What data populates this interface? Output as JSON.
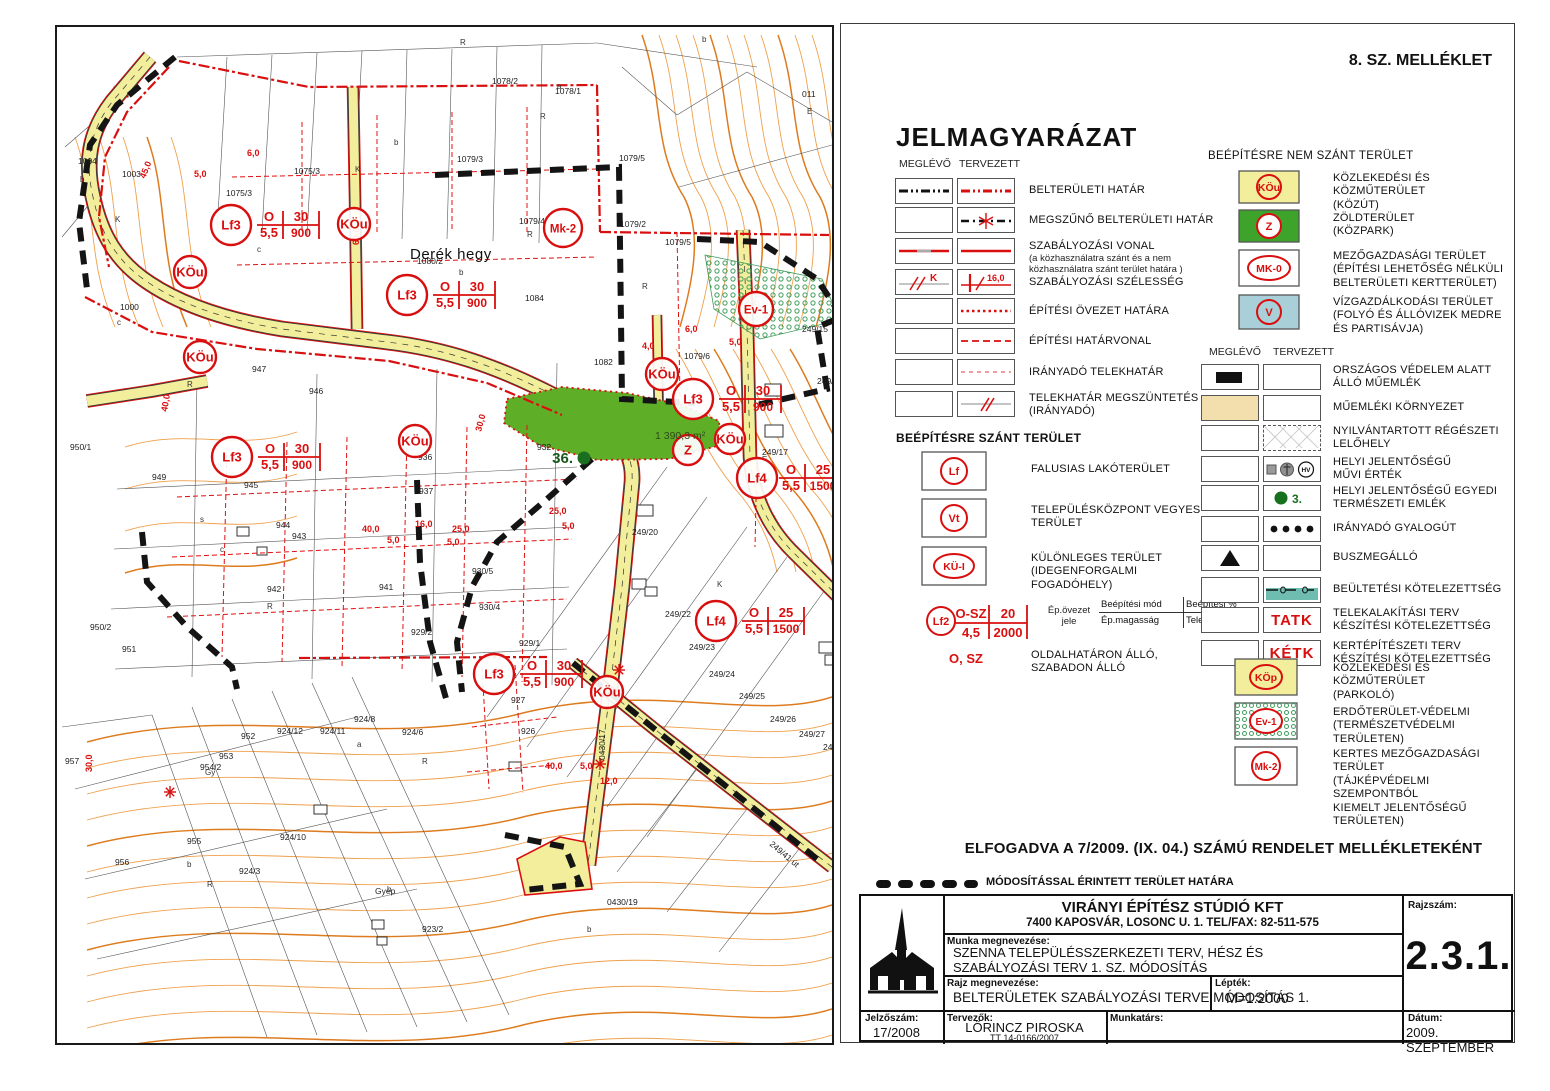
{
  "sheet": {
    "attachment": "8. SZ. MELLÉKLET"
  },
  "legend": {
    "title": "JELMAGYARÁZAT",
    "col_existing": "MEGLÉVŐ",
    "col_planned": "TERVEZETT",
    "left_rows": [
      {
        "label": "BELTERÜLETI HATÁR"
      },
      {
        "label": "MEGSZŰNŐ BELTERÜLETI HATÁR"
      },
      {
        "label": "SZABÁLYOZÁSI VONAL",
        "note": "(a közhasználatra szánt és a nem\nközhasználatra szánt terület határa )"
      },
      {
        "label": "SZABÁLYOZÁSI SZÉLESSÉG",
        "k": "K",
        "w": "16,0"
      },
      {
        "label": "ÉPÍTÉSI ÖVEZET HATÁRA"
      },
      {
        "label": "ÉPÍTÉSI HATÁRVONAL"
      },
      {
        "label": "IRÁNYADÓ TELEKHATÁR"
      },
      {
        "label": "TELEKHATÁR MEGSZÜNTETÉS\n(IRÁNYADÓ)"
      }
    ],
    "szant": {
      "header": "BEÉPÍTÉSRE SZÁNT TERÜLET",
      "items": [
        {
          "symbol": "Lf",
          "label": "FALUSIAS LAKÓTERÜLET"
        },
        {
          "symbol": "Vt",
          "label": "TELEPÜLÉSKÖZPONT VEGYES\nTERÜLET"
        },
        {
          "symbol": "KÜ-I",
          "label": "KÜLÖNLEGES TERÜLET\n(IDEGENFORGALMI FOGADÓHELY)"
        }
      ],
      "formula": {
        "symbol": "Lf2",
        "tl": "O-SZ",
        "tr": "20",
        "bl": "4,5",
        "br": "2000",
        "caption_left": "Ép.övezet\njele",
        "cap_tl": "Beépítési mód",
        "cap_tr": "Beépítési %",
        "cap_bl": "Ép.magasság",
        "cap_br": "Telekterület"
      },
      "osz": {
        "symbol": "O, SZ",
        "label": "OLDALHATÁRON ÁLLÓ,\nSZABADON ÁLLÓ"
      }
    },
    "nem_szant": {
      "header": "BEÉPÍTÉSRE NEM  SZÁNT TERÜLET",
      "items": [
        {
          "symbol": "KÖu",
          "fill": "#f2ee9b",
          "label": "KÖZLEKEDÉSI ÉS KÖZMŰTERÜLET\n(KÖZÚT)"
        },
        {
          "symbol": "Z",
          "fill": "#3ea32b",
          "label": "ZÖLDTERÜLET\n(KÖZPARK)"
        },
        {
          "symbol": "MK-0",
          "fill": "#ffffff",
          "label": "MEZŐGAZDASÁGI TERÜLET\n(ÉPÍTÉSI LEHETŐSÉG NÉLKÜLI\nBELTERÜLETI KERTTERÜLET)"
        },
        {
          "symbol": "V",
          "fill": "#a9d0d9",
          "label": "VÍZGAZDÁLKODÁSI TERÜLET\n(FOLYÓ ÉS ÁLLÓVIZEK MEDRE\nÉS PARTISÁVJA)"
        }
      ]
    },
    "pair_rows": [
      {
        "label": "ORSZÁGOS VÉDELEM ALATT\nÁLLÓ MŰEMLÉK"
      },
      {
        "label": "MŰEMLÉKI KÖRNYEZET"
      },
      {
        "label": "NYILVÁNTARTOTT RÉGÉSZETI\nLELŐHELY"
      },
      {
        "label": "HELYI JELENTŐSÉGŰ\nMŰVI ÉRTÉK",
        "hv": "HV"
      },
      {
        "label": "HELYI JELENTŐSÉGŰ EGYEDI\nTERMÉSZETI EMLÉK",
        "num": "3."
      },
      {
        "label": "IRÁNYADÓ GYALOGÚT"
      },
      {
        "label": "BUSZMEGÁLLÓ"
      },
      {
        "label": "BEÜLTETÉSI KÖTELEZETTSÉG"
      },
      {
        "label": "TELEKALAKÍTÁSI TERV\nKÉSZÍTÉSI KÖTELEZETTSÉG",
        "mark": "TATK"
      },
      {
        "label": "KERTÉPÍTÉSZETI TERV\nKÉSZÍTÉSI KÖTELEZETTSÉG",
        "mark": "KÉTK"
      }
    ],
    "bottom_symbols": [
      {
        "symbol": "KÖp",
        "label": "KÖZLEKEDÉSI ÉS KÖZMŰTERÜLET\n(PARKOLÓ)"
      },
      {
        "symbol": "Ev-1",
        "label": "ERDŐTERÜLET-VÉDELMI\n(TERMÉSZETVÉDELMI TERÜLETEN)"
      },
      {
        "symbol": "Mk-2",
        "label": "KERTES MEZŐGAZDASÁGI TERÜLET\n(TÁJKÉPVÉDELMI SZEMPONTBÓL\nKIEMELT JELENTŐSÉGŰ TERÜLETEN)"
      }
    ],
    "colors": {
      "red": "#d90f0f",
      "road_yellow": "#f2ee9b",
      "park_green": "#5fae27",
      "water_blue": "#a9d0d9",
      "tan": "#f3dfae",
      "teal": "#6fbcb1"
    }
  },
  "adoption": "ELFOGADVA A 7/2009. (IX. 04.) SZÁMÚ RENDELET MELLÉKLETEKÉNT",
  "modified_boundary": "MÓDOSÍTÁSSAL ÉRINTETT TERÜLET HATÁRA",
  "title_block": {
    "firm": "VIRÁNYI ÉPÍTÉSZ STÚDIÓ KFT",
    "firm_address": "7400 KAPOSVÁR, LOSONC U. 1. TEL/FAX: 82-511-575",
    "work_label": "Munka megnevezése:",
    "work_name": "SZENNA TELEPÜLÉSSZERKEZETI TERV, HÉSZ ÉS\nSZABÁLYOZÁSI TERV 1. SZ. MÓDOSÍTÁS",
    "drawing_label": "Rajz megnevezése:",
    "drawing_name": "BELTERÜLETEK SZABÁLYOZÁSI TERVE MÓDOSÍTÁS 1.",
    "scale_label": "Lépték:",
    "scale": "M=1:2000",
    "number_label": "Rajzszám:",
    "number": "2.3.1.",
    "code_label": "Jelzőszám:",
    "code": "17/2008",
    "designers_label": "Tervezők:",
    "designer": "LŐRINCZ PIROSKA",
    "designer_reg": "TT 14-0166/2007",
    "collaborator_label": "Munkatárs:",
    "date_label": "Dátum:",
    "date": "2009. SZEPTEMBER"
  },
  "map": {
    "place": "Derék hegy",
    "green_area": "1 390,3 m²",
    "monument": "36.",
    "symbols": [
      {
        "t": "KÖu",
        "x": 133,
        "y": 245,
        "r": 16
      },
      {
        "t": "KÖu",
        "x": 143,
        "y": 330,
        "r": 16
      },
      {
        "t": "KÖu",
        "x": 297,
        "y": 197,
        "r": 16
      },
      {
        "t": "KÖu",
        "x": 358,
        "y": 414,
        "r": 16
      },
      {
        "t": "KÖu",
        "x": 605,
        "y": 347,
        "r": 16
      },
      {
        "t": "KÖu",
        "x": 673,
        "y": 412,
        "r": 15
      },
      {
        "t": "KÖu",
        "x": 550,
        "y": 665,
        "r": 16
      },
      {
        "t": "Lf3",
        "x": 174,
        "y": 198,
        "r": 20
      },
      {
        "t": "Lf3",
        "x": 350,
        "y": 268,
        "r": 20
      },
      {
        "t": "Lf3",
        "x": 175,
        "y": 430,
        "r": 20
      },
      {
        "t": "Lf3",
        "x": 636,
        "y": 372,
        "r": 20
      },
      {
        "t": "Lf3",
        "x": 437,
        "y": 647,
        "r": 20
      },
      {
        "t": "Lf4",
        "x": 700,
        "y": 451,
        "r": 20
      },
      {
        "t": "Lf4",
        "x": 659,
        "y": 594,
        "r": 20
      },
      {
        "t": "Mk-2",
        "x": 506,
        "y": 201,
        "r": 19
      },
      {
        "t": "Ev-1",
        "x": 699,
        "y": 282,
        "r": 17
      },
      {
        "t": "Z",
        "x": 631,
        "y": 423,
        "r": 15
      }
    ],
    "tables": [
      {
        "x": 200,
        "y": 198,
        "tl": "O",
        "tr": "30",
        "bl": "5,5",
        "br": "900"
      },
      {
        "x": 376,
        "y": 268,
        "tl": "O",
        "tr": "30",
        "bl": "5,5",
        "br": "900"
      },
      {
        "x": 201,
        "y": 430,
        "tl": "O",
        "tr": "30",
        "bl": "5,5",
        "br": "900"
      },
      {
        "x": 662,
        "y": 372,
        "tl": "O",
        "tr": "30",
        "bl": "5,5",
        "br": "900"
      },
      {
        "x": 463,
        "y": 647,
        "tl": "O",
        "tr": "30",
        "bl": "5,5",
        "br": "900"
      },
      {
        "x": 722,
        "y": 451,
        "tl": "O",
        "tr": "25",
        "bl": "5,5",
        "br": "1500"
      },
      {
        "x": 685,
        "y": 594,
        "tl": "O",
        "tr": "25",
        "bl": "5,5",
        "br": "1500"
      }
    ],
    "parcels": [
      {
        "t": "1004",
        "x": 21,
        "y": 137
      },
      {
        "t": "1003",
        "x": 65,
        "y": 150
      },
      {
        "t": "1000",
        "x": 63,
        "y": 283
      },
      {
        "t": "950/1",
        "x": 13,
        "y": 423
      },
      {
        "t": "949",
        "x": 95,
        "y": 453
      },
      {
        "t": "950/2",
        "x": 33,
        "y": 603
      },
      {
        "t": "951",
        "x": 65,
        "y": 625
      },
      {
        "t": "957",
        "x": 8,
        "y": 737
      },
      {
        "t": "954/2",
        "x": 143,
        "y": 743
      },
      {
        "t": "953",
        "x": 162,
        "y": 732
      },
      {
        "t": "952",
        "x": 184,
        "y": 712
      },
      {
        "t": "955",
        "x": 130,
        "y": 817
      },
      {
        "t": "956",
        "x": 58,
        "y": 838
      },
      {
        "t": "924/12",
        "x": 220,
        "y": 707
      },
      {
        "t": "924/11",
        "x": 263,
        "y": 707
      },
      {
        "t": "924/8",
        "x": 297,
        "y": 695
      },
      {
        "t": "924/6",
        "x": 345,
        "y": 708
      },
      {
        "t": "924/10",
        "x": 223,
        "y": 813
      },
      {
        "t": "924/3",
        "x": 182,
        "y": 847
      },
      {
        "t": "923/2",
        "x": 365,
        "y": 905
      },
      {
        "t": "Gyep",
        "x": 318,
        "y": 867
      },
      {
        "t": "1075/3",
        "x": 237,
        "y": 147
      },
      {
        "t": "1075/3",
        "x": 169,
        "y": 169
      },
      {
        "t": "1078/2",
        "x": 435,
        "y": 57
      },
      {
        "t": "1078/1",
        "x": 498,
        "y": 67
      },
      {
        "t": "1079/3",
        "x": 400,
        "y": 135
      },
      {
        "t": "1079/5",
        "x": 562,
        "y": 134
      },
      {
        "t": "1079/5",
        "x": 608,
        "y": 218
      },
      {
        "t": "1079/4",
        "x": 462,
        "y": 197
      },
      {
        "t": "1079/2",
        "x": 563,
        "y": 200
      },
      {
        "t": "1079/6",
        "x": 627,
        "y": 332
      },
      {
        "t": "1080/2",
        "x": 360,
        "y": 237
      },
      {
        "t": "1082",
        "x": 537,
        "y": 338
      },
      {
        "t": "1084",
        "x": 468,
        "y": 274
      },
      {
        "t": "011",
        "x": 745,
        "y": 70
      },
      {
        "t": "249/15",
        "x": 745,
        "y": 305
      },
      {
        "t": "249/16",
        "x": 760,
        "y": 357
      },
      {
        "t": "249/14",
        "x": 778,
        "y": 409
      },
      {
        "t": "249/17",
        "x": 705,
        "y": 428
      },
      {
        "t": "249/20",
        "x": 575,
        "y": 508
      },
      {
        "t": "249/22",
        "x": 608,
        "y": 590
      },
      {
        "t": "249/23",
        "x": 632,
        "y": 623
      },
      {
        "t": "249/24",
        "x": 652,
        "y": 650
      },
      {
        "t": "249/25",
        "x": 682,
        "y": 672
      },
      {
        "t": "249/26",
        "x": 713,
        "y": 695
      },
      {
        "t": "249/27",
        "x": 742,
        "y": 710
      },
      {
        "t": "249/28",
        "x": 766,
        "y": 723
      },
      {
        "t": "932",
        "x": 480,
        "y": 423
      },
      {
        "t": "936",
        "x": 361,
        "y": 433
      },
      {
        "t": "937",
        "x": 362,
        "y": 467
      },
      {
        "t": "941",
        "x": 322,
        "y": 563
      },
      {
        "t": "942",
        "x": 210,
        "y": 565
      },
      {
        "t": "943",
        "x": 235,
        "y": 512
      },
      {
        "t": "944",
        "x": 219,
        "y": 501
      },
      {
        "t": "945",
        "x": 187,
        "y": 461
      },
      {
        "t": "946",
        "x": 252,
        "y": 367
      },
      {
        "t": "947",
        "x": 195,
        "y": 345
      },
      {
        "t": "929/1",
        "x": 462,
        "y": 619
      },
      {
        "t": "927",
        "x": 454,
        "y": 676
      },
      {
        "t": "926",
        "x": 464,
        "y": 707
      },
      {
        "t": "929/2",
        "x": 354,
        "y": 608
      },
      {
        "t": "930/5",
        "x": 415,
        "y": 547
      },
      {
        "t": "930/4",
        "x": 422,
        "y": 583
      },
      {
        "t": "0430/17",
        "x": 548,
        "y": 733,
        "rot": -90
      },
      {
        "t": "0430/19",
        "x": 550,
        "y": 878
      },
      {
        "t": "249/41  út",
        "x": 712,
        "y": 818,
        "rot": 40
      }
    ],
    "letters": [
      {
        "t": "R",
        "x": 403,
        "y": 18
      },
      {
        "t": "b",
        "x": 645,
        "y": 15
      },
      {
        "t": "a",
        "x": 500,
        "y": 62
      },
      {
        "t": "R",
        "x": 483,
        "y": 92
      },
      {
        "t": "b",
        "x": 337,
        "y": 118
      },
      {
        "t": "K",
        "x": 298,
        "y": 145
      },
      {
        "t": "b",
        "x": 23,
        "y": 155
      },
      {
        "t": "K",
        "x": 58,
        "y": 195
      },
      {
        "t": "a",
        "x": 170,
        "y": 182
      },
      {
        "t": "c",
        "x": 200,
        "y": 225
      },
      {
        "t": "c",
        "x": 60,
        "y": 298
      },
      {
        "t": "R",
        "x": 130,
        "y": 360
      },
      {
        "t": "b",
        "x": 402,
        "y": 248
      },
      {
        "t": "R",
        "x": 470,
        "y": 210
      },
      {
        "t": "a",
        "x": 160,
        "y": 440
      },
      {
        "t": "s",
        "x": 143,
        "y": 495
      },
      {
        "t": "c",
        "x": 163,
        "y": 525
      },
      {
        "t": "R",
        "x": 210,
        "y": 582
      },
      {
        "t": "Gy",
        "x": 148,
        "y": 748
      },
      {
        "t": "b",
        "x": 130,
        "y": 840
      },
      {
        "t": "R",
        "x": 150,
        "y": 860
      },
      {
        "t": "a",
        "x": 300,
        "y": 720
      },
      {
        "t": "R",
        "x": 365,
        "y": 737
      },
      {
        "t": "b",
        "x": 330,
        "y": 865
      },
      {
        "t": "E",
        "x": 750,
        "y": 87
      },
      {
        "t": "E",
        "x": 705,
        "y": 435
      },
      {
        "t": "b",
        "x": 708,
        "y": 455
      },
      {
        "t": "K",
        "x": 660,
        "y": 560
      },
      {
        "t": "R",
        "x": 585,
        "y": 262
      },
      {
        "t": "b",
        "x": 530,
        "y": 905
      }
    ],
    "dims": [
      {
        "t": "6,0",
        "x": 190,
        "y": 129
      },
      {
        "t": "5,0",
        "x": 137,
        "y": 150
      },
      {
        "t": "60,0",
        "x": 302,
        "y": 218,
        "rot": -90
      },
      {
        "t": "45,0",
        "x": 88,
        "y": 152,
        "rot": -68
      },
      {
        "t": "40,0",
        "x": 110,
        "y": 385,
        "rot": -80
      },
      {
        "t": "16,0",
        "x": 358,
        "y": 500
      },
      {
        "t": "40,0",
        "x": 305,
        "y": 505
      },
      {
        "t": "25,0",
        "x": 395,
        "y": 505
      },
      {
        "t": "5,0",
        "x": 330,
        "y": 516
      },
      {
        "t": "5,0",
        "x": 390,
        "y": 518
      },
      {
        "t": "4,0",
        "x": 585,
        "y": 322
      },
      {
        "t": "6,0",
        "x": 628,
        "y": 305
      },
      {
        "t": "5,0",
        "x": 672,
        "y": 318
      },
      {
        "t": "25,0",
        "x": 492,
        "y": 487
      },
      {
        "t": "5,0",
        "x": 505,
        "y": 502
      },
      {
        "t": "30,0",
        "x": 424,
        "y": 405,
        "rot": -75
      },
      {
        "t": "30,0",
        "x": 35,
        "y": 745,
        "rot": -90
      },
      {
        "t": "12,0",
        "x": 543,
        "y": 757
      },
      {
        "t": "40,0",
        "x": 488,
        "y": 742
      },
      {
        "t": "5,0",
        "x": 523,
        "y": 742
      }
    ]
  }
}
